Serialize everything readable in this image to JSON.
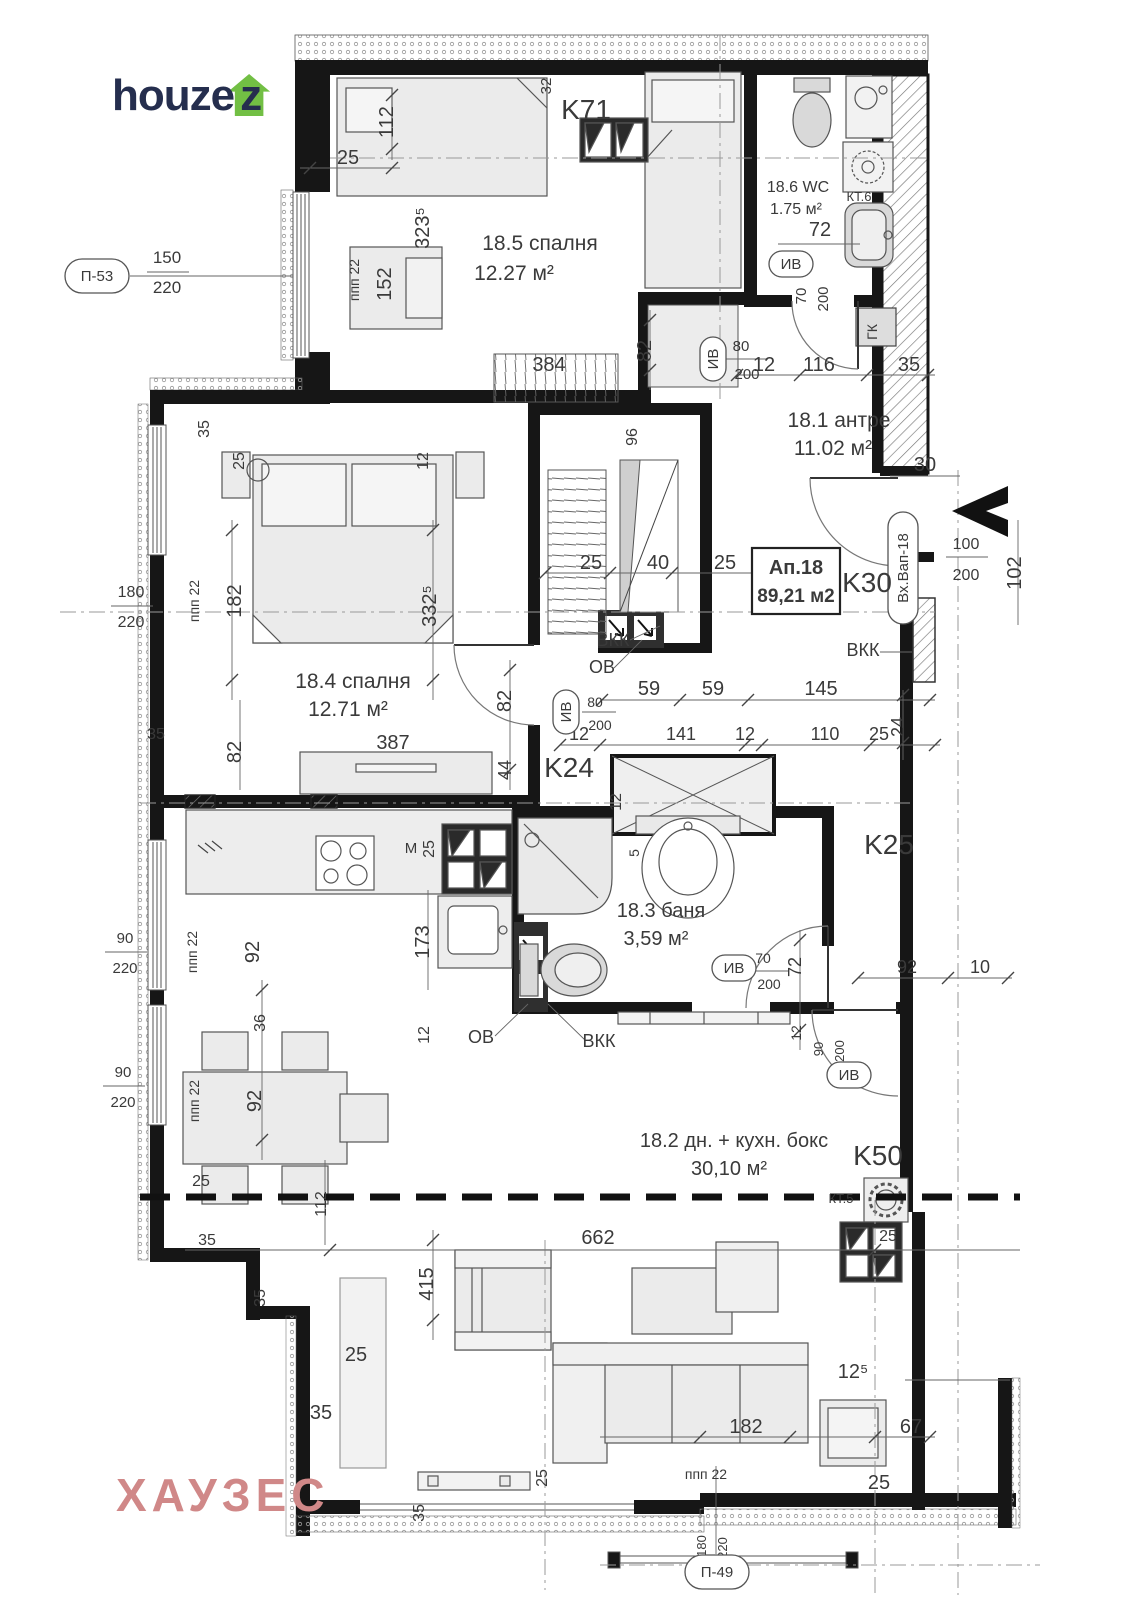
{
  "branding": {
    "logo_prefix": "houze",
    "logo_suffix": "z",
    "watermark": "ХАУЗЕС",
    "logo_color": "#252e4e",
    "logo_house_color": "#72bf44",
    "watermark_color": "#d08888"
  },
  "apartment": {
    "tag": "Ап.18",
    "area": "89,21 м2"
  },
  "rooms": [
    {
      "name": "18.5 спалня",
      "area": "12.27 м²",
      "x": 540,
      "y": 250,
      "ax": 514,
      "ay": 280,
      "fs": 21
    },
    {
      "name": "18.6 WC",
      "area": "1.75 м²",
      "x": 798,
      "y": 192,
      "ax": 796,
      "ay": 214,
      "fs": 16
    },
    {
      "name": "18.1 антре",
      "area": "11.02 м²",
      "x": 839,
      "y": 427,
      "ax": 833,
      "ay": 455,
      "fs": 21
    },
    {
      "name": "18.4 спалня",
      "area": "12.71 м²",
      "x": 353,
      "y": 688,
      "ax": 348,
      "ay": 716,
      "fs": 21
    },
    {
      "name": "18.3 баня",
      "area": "3,59 м²",
      "x": 661,
      "y": 917,
      "ax": 656,
      "ay": 945,
      "fs": 20
    },
    {
      "name": "18.2 дн. + кухн. бокс",
      "area": "30,10 м²",
      "x": 734,
      "y": 1147,
      "ax": 729,
      "ay": 1175,
      "fs": 20
    }
  ],
  "columns": [
    {
      "label": "K71",
      "x": 586,
      "y": 119
    },
    {
      "label": "K30",
      "x": 867,
      "y": 592
    },
    {
      "label": "K24",
      "x": 569,
      "y": 777
    },
    {
      "label": "K25",
      "x": 889,
      "y": 854
    },
    {
      "label": "K50",
      "x": 878,
      "y": 1165
    }
  ],
  "tags": [
    {
      "t": "П-53",
      "x": 97,
      "y": 276,
      "w": 64,
      "h": 34
    },
    {
      "t": "ИВ",
      "x": 791,
      "y": 264,
      "w": 44,
      "h": 26
    },
    {
      "t": "ИВ",
      "x": 713,
      "y": 359,
      "w": 44,
      "h": 26,
      "r": -90
    },
    {
      "t": "ИВ",
      "x": 566,
      "y": 712,
      "w": 44,
      "h": 26,
      "r": -90
    },
    {
      "t": "ИВ",
      "x": 734,
      "y": 968,
      "w": 44,
      "h": 26
    },
    {
      "t": "ИВ",
      "x": 849,
      "y": 1075,
      "w": 44,
      "h": 26
    },
    {
      "t": "Вх.Вап-18",
      "x": 903,
      "y": 568,
      "w": 112,
      "h": 30,
      "r": -90
    },
    {
      "t": "П-49",
      "x": 717,
      "y": 1572,
      "w": 64,
      "h": 34
    }
  ],
  "annotations": [
    {
      "t": "КТ.6",
      "x": 859,
      "y": 201,
      "fs": 13
    },
    {
      "t": "ГК",
      "x": 877,
      "y": 332,
      "fs": 14,
      "r": -90
    },
    {
      "t": "ВКК",
      "x": 613,
      "y": 646,
      "fs": 18
    },
    {
      "t": "ОВ",
      "x": 602,
      "y": 673,
      "fs": 18
    },
    {
      "t": "ВКК",
      "x": 863,
      "y": 656,
      "fs": 18
    },
    {
      "t": "ОВ",
      "x": 481,
      "y": 1043,
      "fs": 18
    },
    {
      "t": "ВКК",
      "x": 599,
      "y": 1047,
      "fs": 18
    },
    {
      "t": "М",
      "x": 411,
      "y": 853,
      "fs": 15
    },
    {
      "t": "КТ.5",
      "x": 841,
      "y": 1203,
      "fs": 13
    }
  ],
  "dims": [
    {
      "t": "25",
      "x": 348,
      "y": 164
    },
    {
      "t": "112",
      "x": 393,
      "y": 122,
      "r": -90
    },
    {
      "t": "32",
      "x": 551,
      "y": 86,
      "r": -90,
      "fs": 15
    },
    {
      "t": "323⁵",
      "x": 429,
      "y": 228,
      "r": -90
    },
    {
      "t": "152",
      "x": 391,
      "y": 284,
      "r": -90
    },
    {
      "t": "ппп  22",
      "x": 359,
      "y": 280,
      "r": -90,
      "fs": 14
    },
    {
      "t": "150",
      "x": 167,
      "y": 263,
      "fs": 17
    },
    {
      "t": "220",
      "x": 167,
      "y": 293,
      "fs": 17
    },
    {
      "t": "72",
      "x": 820,
      "y": 236
    },
    {
      "t": "70",
      "x": 806,
      "y": 296,
      "r": -90,
      "fs": 15
    },
    {
      "t": "200",
      "x": 828,
      "y": 299,
      "r": -90,
      "fs": 15
    },
    {
      "t": "384",
      "x": 549,
      "y": 371
    },
    {
      "t": "82",
      "x": 651,
      "y": 351,
      "r": -90
    },
    {
      "t": "80",
      "x": 741,
      "y": 351,
      "fs": 15
    },
    {
      "t": "200",
      "x": 747,
      "y": 379,
      "fs": 15
    },
    {
      "t": "12",
      "x": 764,
      "y": 371
    },
    {
      "t": "116",
      "x": 819,
      "y": 371
    },
    {
      "t": "35",
      "x": 909,
      "y": 371
    },
    {
      "t": "96",
      "x": 637,
      "y": 437,
      "r": -90,
      "fs": 16
    },
    {
      "t": "35",
      "x": 209,
      "y": 429,
      "r": -90,
      "fs": 16
    },
    {
      "t": "25",
      "x": 244,
      "y": 461,
      "r": -90,
      "fs": 16
    },
    {
      "t": "12",
      "x": 428,
      "y": 461,
      "r": -90,
      "fs": 16
    },
    {
      "t": "30",
      "x": 925,
      "y": 471
    },
    {
      "t": "100",
      "x": 966,
      "y": 549,
      "fs": 16
    },
    {
      "t": "200",
      "x": 966,
      "y": 580,
      "fs": 16
    },
    {
      "t": "102",
      "x": 1021,
      "y": 573,
      "r": -90
    },
    {
      "t": "25",
      "x": 591,
      "y": 569
    },
    {
      "t": "40",
      "x": 658,
      "y": 569
    },
    {
      "t": "25",
      "x": 725,
      "y": 569
    },
    {
      "t": "180",
      "x": 131,
      "y": 597,
      "fs": 16
    },
    {
      "t": "220",
      "x": 131,
      "y": 627,
      "fs": 16
    },
    {
      "t": "ппп  22",
      "x": 199,
      "y": 601,
      "r": -90,
      "fs": 14
    },
    {
      "t": "182",
      "x": 241,
      "y": 601,
      "r": -90
    },
    {
      "t": "332⁵",
      "x": 436,
      "y": 606,
      "r": -90
    },
    {
      "t": "82",
      "x": 511,
      "y": 701,
      "r": -90
    },
    {
      "t": "59",
      "x": 649,
      "y": 695
    },
    {
      "t": "59",
      "x": 713,
      "y": 695
    },
    {
      "t": "145",
      "x": 821,
      "y": 695
    },
    {
      "t": "80",
      "x": 595,
      "y": 707,
      "fs": 14
    },
    {
      "t": "200",
      "x": 600,
      "y": 730,
      "fs": 14
    },
    {
      "t": "12",
      "x": 579,
      "y": 740,
      "fs": 18
    },
    {
      "t": "141",
      "x": 681,
      "y": 740,
      "fs": 18
    },
    {
      "t": "12",
      "x": 745,
      "y": 740,
      "fs": 18
    },
    {
      "t": "110",
      "x": 825,
      "y": 740,
      "fs": 18
    },
    {
      "t": "25",
      "x": 879,
      "y": 740,
      "fs": 18
    },
    {
      "t": "24",
      "x": 904,
      "y": 727,
      "r": -90,
      "fs": 18
    },
    {
      "t": "35",
      "x": 156,
      "y": 739,
      "fs": 16
    },
    {
      "t": "82",
      "x": 241,
      "y": 752,
      "r": -90
    },
    {
      "t": "387",
      "x": 393,
      "y": 749
    },
    {
      "t": "44",
      "x": 511,
      "y": 770,
      "r": -90,
      "fs": 18
    },
    {
      "t": "12",
      "x": 621,
      "y": 802,
      "r": -90,
      "fs": 16
    },
    {
      "t": "25",
      "x": 434,
      "y": 849,
      "r": -90,
      "fs": 16
    },
    {
      "t": "5",
      "x": 639,
      "y": 853,
      "r": -90,
      "fs": 14
    },
    {
      "t": "173",
      "x": 429,
      "y": 942,
      "r": -90
    },
    {
      "t": "92",
      "x": 259,
      "y": 952,
      "r": -90
    },
    {
      "t": "ппп  22",
      "x": 197,
      "y": 952,
      "r": -90,
      "fs": 14
    },
    {
      "t": "90",
      "x": 125,
      "y": 943,
      "fs": 15
    },
    {
      "t": "220",
      "x": 125,
      "y": 973,
      "fs": 15
    },
    {
      "t": "70",
      "x": 763,
      "y": 963,
      "fs": 14
    },
    {
      "t": "200",
      "x": 769,
      "y": 989,
      "fs": 14
    },
    {
      "t": "72",
      "x": 801,
      "y": 967,
      "r": -90,
      "fs": 18
    },
    {
      "t": "92",
      "x": 907,
      "y": 973,
      "fs": 18
    },
    {
      "t": "10",
      "x": 980,
      "y": 973,
      "fs": 18
    },
    {
      "t": "12",
      "x": 801,
      "y": 1033,
      "r": -90,
      "fs": 14
    },
    {
      "t": "90",
      "x": 823,
      "y": 1049,
      "r": -90,
      "fs": 13
    },
    {
      "t": "200",
      "x": 844,
      "y": 1051,
      "r": -90,
      "fs": 13
    },
    {
      "t": "12",
      "x": 429,
      "y": 1035,
      "r": -90,
      "fs": 16
    },
    {
      "t": "36",
      "x": 265,
      "y": 1023,
      "r": -90,
      "fs": 16
    },
    {
      "t": "92",
      "x": 261,
      "y": 1101,
      "r": -90
    },
    {
      "t": "ппп  22",
      "x": 199,
      "y": 1101,
      "r": -90,
      "fs": 14
    },
    {
      "t": "90",
      "x": 123,
      "y": 1077,
      "fs": 15
    },
    {
      "t": "220",
      "x": 123,
      "y": 1107,
      "fs": 15
    },
    {
      "t": "25",
      "x": 201,
      "y": 1186,
      "fs": 16
    },
    {
      "t": "112",
      "x": 326,
      "y": 1204,
      "r": -90,
      "fs": 16
    },
    {
      "t": "662",
      "x": 598,
      "y": 1244
    },
    {
      "t": "35",
      "x": 207,
      "y": 1245,
      "fs": 16
    },
    {
      "t": "415",
      "x": 433,
      "y": 1284,
      "r": -90
    },
    {
      "t": "35",
      "x": 265,
      "y": 1298,
      "r": -90,
      "fs": 16
    },
    {
      "t": "25",
      "x": 888,
      "y": 1241,
      "fs": 16
    },
    {
      "t": "25",
      "x": 356,
      "y": 1361
    },
    {
      "t": "35",
      "x": 321,
      "y": 1419
    },
    {
      "t": "12⁵",
      "x": 853,
      "y": 1378
    },
    {
      "t": "182",
      "x": 746,
      "y": 1433
    },
    {
      "t": "67",
      "x": 911,
      "y": 1433
    },
    {
      "t": "25",
      "x": 879,
      "y": 1489
    },
    {
      "t": "ппп  22",
      "x": 706,
      "y": 1479,
      "fs": 14
    },
    {
      "t": "35",
      "x": 424,
      "y": 1513,
      "r": -90,
      "fs": 16
    },
    {
      "t": "25",
      "x": 547,
      "y": 1478,
      "r": -90,
      "fs": 16
    },
    {
      "t": "180",
      "x": 706,
      "y": 1546,
      "r": -90,
      "fs": 13
    },
    {
      "t": "220",
      "x": 727,
      "y": 1548,
      "r": -90,
      "fs": 13
    }
  ]
}
